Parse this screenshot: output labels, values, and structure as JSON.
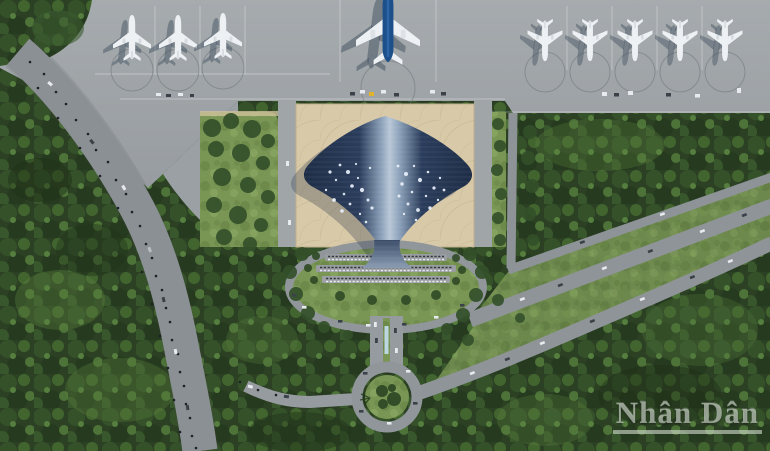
{
  "watermark": {
    "text": "Nhân Dân"
  },
  "scene": {
    "subject": "aerial rendering of airport: manta-ray-roof terminal, apron with parked aircraft, oval landscaped forecourt with parking, roundabout, forest roads",
    "aircraft": {
      "white_left_count": 3,
      "blue_center_count": 1,
      "white_right_count": 5
    },
    "colors": {
      "forest_green": "#2c4123",
      "grass_green": "#7a9655",
      "apron_gray": "#9ba0a4",
      "road_gray": "#8e9498",
      "plaza_beige": "#d8c9a9",
      "roof_navy": "#223350",
      "roof_highlight": "#aec0d2",
      "aircraft_blue": "#1d4f8a",
      "aircraft_white": "#eef1f4",
      "fountain_blue": "#bcd6e2",
      "service_vehicle_yellow": "#e0b52c"
    }
  }
}
